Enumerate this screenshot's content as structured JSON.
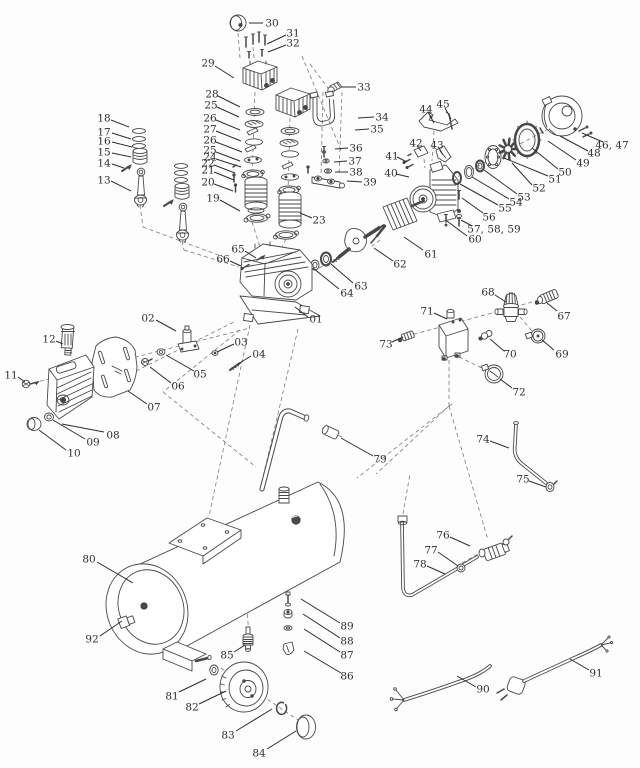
{
  "diagram": {
    "type": "exploded-parts-diagram",
    "colors": {
      "background": "#fdfdfd",
      "line": "#474747",
      "label": "#2e2e2e",
      "dash": "#7a7a7a"
    },
    "part_labels": [
      {
        "t": "01",
        "x": 316,
        "y": 319,
        "l": [
          308,
          317,
          295,
          307
        ]
      },
      {
        "t": "02",
        "x": 148,
        "y": 318,
        "l": [
          156,
          320,
          176,
          331
        ]
      },
      {
        "t": "03",
        "x": 241,
        "y": 342,
        "l": [
          234,
          344,
          217,
          352
        ]
      },
      {
        "t": "04",
        "x": 259,
        "y": 354,
        "l": [
          251,
          356,
          238,
          364
        ]
      },
      {
        "t": "05",
        "x": 200,
        "y": 374,
        "l": [
          194,
          371,
          166,
          355
        ]
      },
      {
        "t": "06",
        "x": 178,
        "y": 386,
        "l": [
          171,
          383,
          150,
          367
        ]
      },
      {
        "t": "07",
        "x": 154,
        "y": 407,
        "l": [
          147,
          404,
          128,
          391
        ]
      },
      {
        "t": "08",
        "x": 113,
        "y": 435,
        "l": [
          104,
          432,
          62,
          424
        ]
      },
      {
        "t": "09",
        "x": 93,
        "y": 442,
        "l": [
          85,
          439,
          53,
          420
        ]
      },
      {
        "t": "10",
        "x": 74,
        "y": 453,
        "l": [
          66,
          450,
          39,
          430
        ]
      },
      {
        "t": "11",
        "x": 11,
        "y": 375,
        "l": [
          18,
          377,
          25,
          382
        ]
      },
      {
        "t": "12",
        "x": 49,
        "y": 339,
        "l": [
          56,
          341,
          63,
          344
        ]
      },
      {
        "t": "13",
        "x": 104,
        "y": 180,
        "l": [
          111,
          181,
          131,
          191
        ]
      },
      {
        "t": "14",
        "x": 104,
        "y": 163,
        "l": [
          112,
          164,
          124,
          168
        ]
      },
      {
        "t": "15",
        "x": 104,
        "y": 152,
        "l": [
          112,
          153,
          131,
          157
        ]
      },
      {
        "t": "16",
        "x": 104,
        "y": 141,
        "l": [
          112,
          142,
          132,
          147
        ]
      },
      {
        "t": "17",
        "x": 104,
        "y": 132,
        "l": [
          112,
          133,
          131,
          139
        ]
      },
      {
        "t": "18",
        "x": 104,
        "y": 118,
        "l": [
          111,
          120,
          129,
          127
        ]
      },
      {
        "t": "19",
        "x": 213,
        "y": 198,
        "l": [
          220,
          200,
          240,
          211
        ]
      },
      {
        "t": "20",
        "x": 208,
        "y": 182,
        "l": [
          214,
          184,
          233,
          191
        ]
      },
      {
        "t": "21",
        "x": 208,
        "y": 170,
        "l": [
          214,
          172,
          234,
          180
        ]
      },
      {
        "t": "22",
        "x": 208,
        "y": 163,
        "l": [
          214,
          165,
          235,
          173
        ]
      },
      {
        "t": "23",
        "x": 319,
        "y": 220,
        "l": [
          312,
          218,
          300,
          213
        ]
      },
      {
        "t": "24",
        "x": 210,
        "y": 157,
        "l": [
          216,
          159,
          241,
          167
        ]
      },
      {
        "t": "25",
        "x": 211,
        "y": 105,
        "l": [
          217,
          107,
          239,
          117
        ]
      },
      {
        "t": "25",
        "x": 210,
        "y": 150,
        "l": [
          216,
          152,
          240,
          161
        ]
      },
      {
        "t": "26",
        "x": 210,
        "y": 118,
        "l": [
          216,
          120,
          240,
          130
        ]
      },
      {
        "t": "26",
        "x": 210,
        "y": 140,
        "l": [
          216,
          142,
          242,
          152
        ]
      },
      {
        "t": "27",
        "x": 210,
        "y": 129,
        "l": [
          216,
          131,
          241,
          141
        ]
      },
      {
        "t": "28",
        "x": 212,
        "y": 94,
        "l": [
          218,
          96,
          240,
          107
        ]
      },
      {
        "t": "29",
        "x": 208,
        "y": 63,
        "l": [
          215,
          66,
          234,
          78
        ]
      },
      {
        "t": "30",
        "x": 272,
        "y": 23,
        "l": [
          263,
          23,
          249,
          23
        ]
      },
      {
        "t": "31",
        "x": 293,
        "y": 33,
        "l": [
          286,
          35,
          267,
          44
        ]
      },
      {
        "t": "32",
        "x": 293,
        "y": 43,
        "l": [
          286,
          45,
          268,
          52
        ]
      },
      {
        "t": "33",
        "x": 364,
        "y": 87,
        "l": [
          356,
          87,
          342,
          87
        ]
      },
      {
        "t": "34",
        "x": 382,
        "y": 117,
        "l": [
          374,
          117,
          358,
          118
        ]
      },
      {
        "t": "35",
        "x": 377,
        "y": 129,
        "l": [
          369,
          129,
          355,
          130
        ]
      },
      {
        "t": "36",
        "x": 356,
        "y": 148,
        "l": [
          348,
          148,
          335,
          149
        ]
      },
      {
        "t": "37",
        "x": 355,
        "y": 161,
        "l": [
          347,
          161,
          334,
          162
        ]
      },
      {
        "t": "38",
        "x": 356,
        "y": 172,
        "l": [
          348,
          172,
          335,
          172
        ]
      },
      {
        "t": "39",
        "x": 370,
        "y": 182,
        "l": [
          362,
          182,
          347,
          181
        ]
      },
      {
        "t": "40",
        "x": 391,
        "y": 173,
        "l": [
          396,
          174,
          409,
          177
        ]
      },
      {
        "t": "41",
        "x": 392,
        "y": 156,
        "l": [
          397,
          157,
          407,
          162
        ]
      },
      {
        "t": "42",
        "x": 416,
        "y": 143,
        "l": [
          417,
          146,
          421,
          151
        ]
      },
      {
        "t": "43",
        "x": 437,
        "y": 145,
        "l": [
          439,
          148,
          443,
          155
        ]
      },
      {
        "t": "44",
        "x": 426,
        "y": 109,
        "l": [
          428,
          112,
          434,
          123
        ]
      },
      {
        "t": "45",
        "x": 443,
        "y": 104,
        "l": [
          445,
          108,
          451,
          119
        ]
      },
      {
        "t": "46, 47",
        "x": 612,
        "y": 145,
        "l": [
          603,
          142,
          582,
          133
        ]
      },
      {
        "t": "48",
        "x": 594,
        "y": 153,
        "l": [
          588,
          151,
          560,
          136
        ]
      },
      {
        "t": "49",
        "x": 583,
        "y": 163,
        "l": [
          576,
          160,
          548,
          141
        ]
      },
      {
        "t": "50",
        "x": 565,
        "y": 172,
        "l": [
          558,
          169,
          532,
          148
        ]
      },
      {
        "t": "51",
        "x": 555,
        "y": 179,
        "l": [
          548,
          176,
          504,
          158
        ]
      },
      {
        "t": "52",
        "x": 539,
        "y": 188,
        "l": [
          532,
          185,
          512,
          163
        ]
      },
      {
        "t": "53",
        "x": 524,
        "y": 197,
        "l": [
          517,
          194,
          484,
          170
        ]
      },
      {
        "t": "54",
        "x": 516,
        "y": 202,
        "l": [
          509,
          199,
          472,
          177
        ]
      },
      {
        "t": "55",
        "x": 505,
        "y": 208,
        "l": [
          498,
          205,
          460,
          184
        ]
      },
      {
        "t": "56",
        "x": 489,
        "y": 217,
        "l": [
          483,
          213,
          462,
          198
        ]
      },
      {
        "t": "57, 58, 59",
        "x": 494,
        "y": 229,
        "l": [
          472,
          226,
          461,
          220
        ]
      },
      {
        "t": "60",
        "x": 475,
        "y": 239,
        "l": [
          467,
          236,
          447,
          221
        ]
      },
      {
        "t": "61",
        "x": 431,
        "y": 254,
        "l": [
          423,
          250,
          404,
          237
        ]
      },
      {
        "t": "62",
        "x": 400,
        "y": 264,
        "l": [
          393,
          261,
          374,
          248
        ]
      },
      {
        "t": "63",
        "x": 361,
        "y": 286,
        "l": [
          353,
          283,
          331,
          264
        ]
      },
      {
        "t": "64",
        "x": 347,
        "y": 293,
        "l": [
          339,
          289,
          313,
          268
        ]
      },
      {
        "t": "65",
        "x": 238,
        "y": 249,
        "l": [
          245,
          251,
          256,
          258
        ]
      },
      {
        "t": "66",
        "x": 223,
        "y": 259,
        "l": [
          230,
          261,
          241,
          266
        ]
      },
      {
        "t": "67",
        "x": 564,
        "y": 316,
        "l": [
          557,
          311,
          547,
          303
        ]
      },
      {
        "t": "68",
        "x": 488,
        "y": 292,
        "l": [
          495,
          295,
          506,
          302
        ]
      },
      {
        "t": "69",
        "x": 562,
        "y": 354,
        "l": [
          554,
          350,
          542,
          340
        ]
      },
      {
        "t": "70",
        "x": 510,
        "y": 354,
        "l": [
          504,
          351,
          490,
          339
        ]
      },
      {
        "t": "71",
        "x": 427,
        "y": 311,
        "l": [
          434,
          313,
          447,
          319
        ]
      },
      {
        "t": "72",
        "x": 519,
        "y": 392,
        "l": [
          512,
          388,
          500,
          379
        ]
      },
      {
        "t": "73",
        "x": 386,
        "y": 344,
        "l": [
          392,
          342,
          403,
          337
        ]
      },
      {
        "t": "74",
        "x": 483,
        "y": 439,
        "l": [
          490,
          441,
          509,
          448
        ]
      },
      {
        "t": "75",
        "x": 523,
        "y": 479,
        "l": [
          529,
          481,
          546,
          487
        ]
      },
      {
        "t": "76",
        "x": 443,
        "y": 535,
        "l": [
          450,
          537,
          470,
          546
        ]
      },
      {
        "t": "77",
        "x": 431,
        "y": 550,
        "l": [
          438,
          552,
          458,
          566
        ]
      },
      {
        "t": "78",
        "x": 420,
        "y": 564,
        "l": [
          427,
          566,
          445,
          574
        ]
      },
      {
        "t": "79",
        "x": 380,
        "y": 459,
        "l": [
          373,
          456,
          341,
          438
        ]
      },
      {
        "t": "80",
        "x": 89,
        "y": 559,
        "l": [
          97,
          562,
          133,
          583
        ]
      },
      {
        "t": "81",
        "x": 172,
        "y": 696,
        "l": [
          179,
          692,
          206,
          679
        ]
      },
      {
        "t": "82",
        "x": 192,
        "y": 707,
        "l": [
          199,
          704,
          226,
          691
        ]
      },
      {
        "t": "83",
        "x": 228,
        "y": 735,
        "l": [
          236,
          731,
          272,
          709
        ]
      },
      {
        "t": "84",
        "x": 259,
        "y": 753,
        "l": [
          267,
          749,
          296,
          731
        ]
      },
      {
        "t": "85",
        "x": 227,
        "y": 655,
        "l": [
          234,
          652,
          245,
          645
        ]
      },
      {
        "t": "86",
        "x": 347,
        "y": 676,
        "l": [
          341,
          673,
          304,
          651
        ]
      },
      {
        "t": "87",
        "x": 347,
        "y": 655,
        "l": [
          340,
          652,
          304,
          629
        ]
      },
      {
        "t": "88",
        "x": 347,
        "y": 641,
        "l": [
          340,
          638,
          303,
          614
        ]
      },
      {
        "t": "89",
        "x": 347,
        "y": 626,
        "l": [
          340,
          623,
          301,
          599
        ]
      },
      {
        "t": "90",
        "x": 483,
        "y": 689,
        "l": [
          476,
          687,
          457,
          676
        ]
      },
      {
        "t": "91",
        "x": 596,
        "y": 673,
        "l": [
          589,
          670,
          570,
          659
        ]
      },
      {
        "t": "92",
        "x": 92,
        "y": 639,
        "l": [
          100,
          636,
          122,
          621
        ]
      }
    ]
  }
}
